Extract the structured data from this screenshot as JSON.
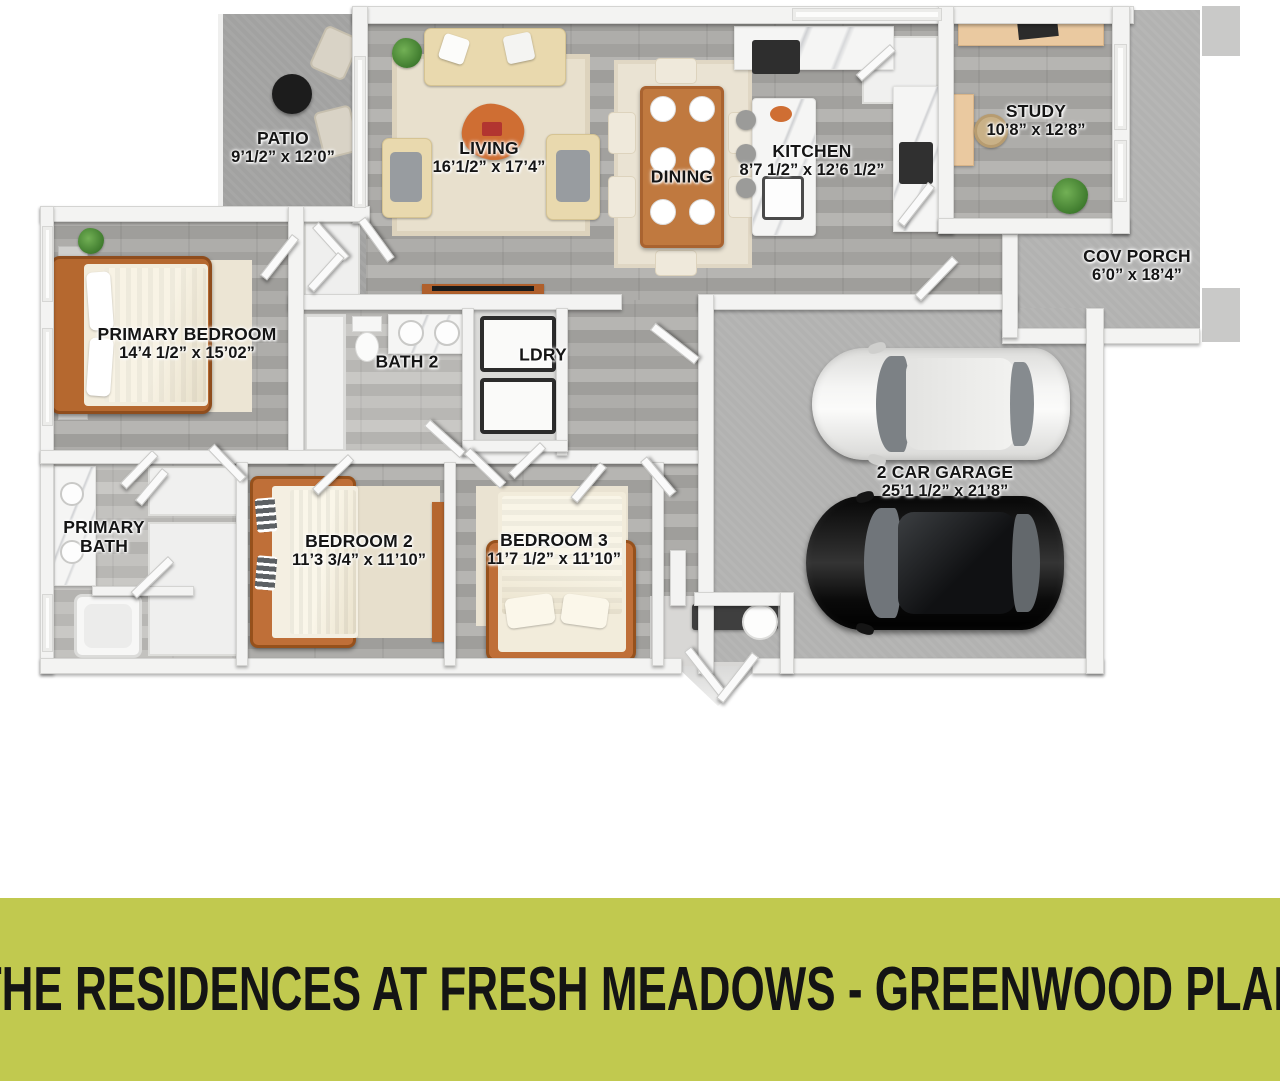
{
  "title": "THE RESIDENCES AT FRESH MEADOWS - GREENWOOD PLAN",
  "colors": {
    "banner": "#c1c94f",
    "label_text": "#151515",
    "accent_wood": "#bf6f38"
  },
  "rooms": {
    "patio": {
      "name": "PATIO",
      "dims": "9’1/2” x 12’0”"
    },
    "living": {
      "name": "LIVING",
      "dims": "16’1/2” x 17’4”"
    },
    "dining": {
      "name": "DINING",
      "dims": ""
    },
    "kitchen": {
      "name": "KITCHEN",
      "dims": "8’7 1/2” x 12’6 1/2”"
    },
    "study": {
      "name": "STUDY",
      "dims": "10’8” x 12’8”"
    },
    "cov_porch": {
      "name": "COV PORCH",
      "dims": "6’0” x 18’4”"
    },
    "primary_bedroom": {
      "name": "PRIMARY BEDROOM",
      "dims": "14’4 1/2” x 15’02”"
    },
    "bath_2": {
      "name": "BATH 2",
      "dims": ""
    },
    "laundry": {
      "name": "LDRY",
      "dims": ""
    },
    "garage": {
      "name": "2 CAR GARAGE",
      "dims": "25’1 1/2” x 21’8”"
    },
    "primary_bath": {
      "name": "PRIMARY BATH",
      "dims": ""
    },
    "bedroom_2": {
      "name": "BEDROOM 2",
      "dims": "11’3 3/4” x 11’10”"
    },
    "bedroom_3": {
      "name": "BEDROOM 3",
      "dims": "11’7 1/2” x 11’10”"
    }
  }
}
